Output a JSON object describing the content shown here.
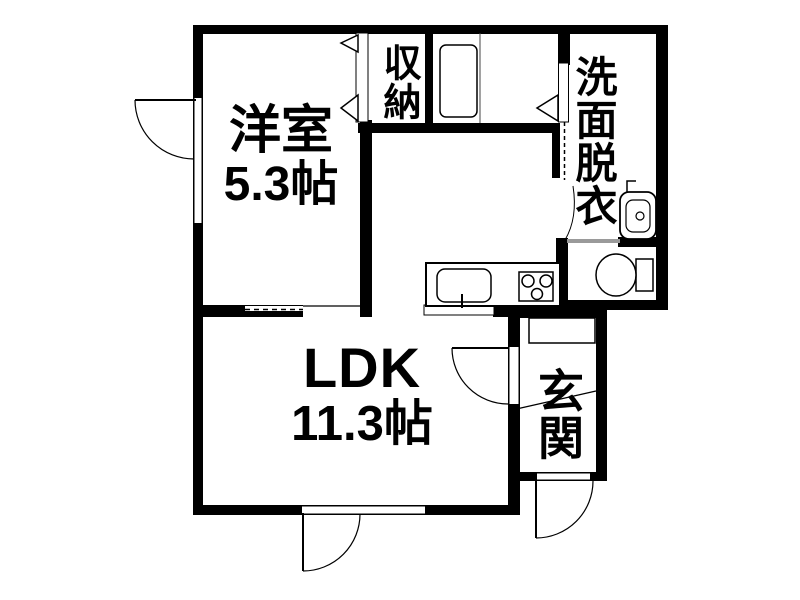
{
  "floorplan": {
    "rooms": {
      "western_room": {
        "label": "洋室",
        "size": "5.3帖"
      },
      "ldk": {
        "label": "LDK",
        "size": "11.3帖"
      },
      "closet": {
        "label": "収納"
      },
      "washroom": {
        "label": "洗面脱衣"
      },
      "entrance": {
        "label": "玄関"
      }
    },
    "fixtures": [
      "kitchen-sink-icon",
      "kitchen-faucet-icon",
      "stove-3-burner-icon",
      "washbasin-icon",
      "toilet-icon",
      "washing-machine-pan-icon",
      "shoe-cabinet-icon"
    ],
    "symbols": [
      "hinged-door-arc",
      "folding-closet-door-triangles",
      "sliding-door-dashed-track",
      "window-opening",
      "entrance-step-line"
    ],
    "colors": {
      "wall": "#000000",
      "floor": "#ffffff",
      "thin_partition": "#9a9a9a"
    }
  }
}
